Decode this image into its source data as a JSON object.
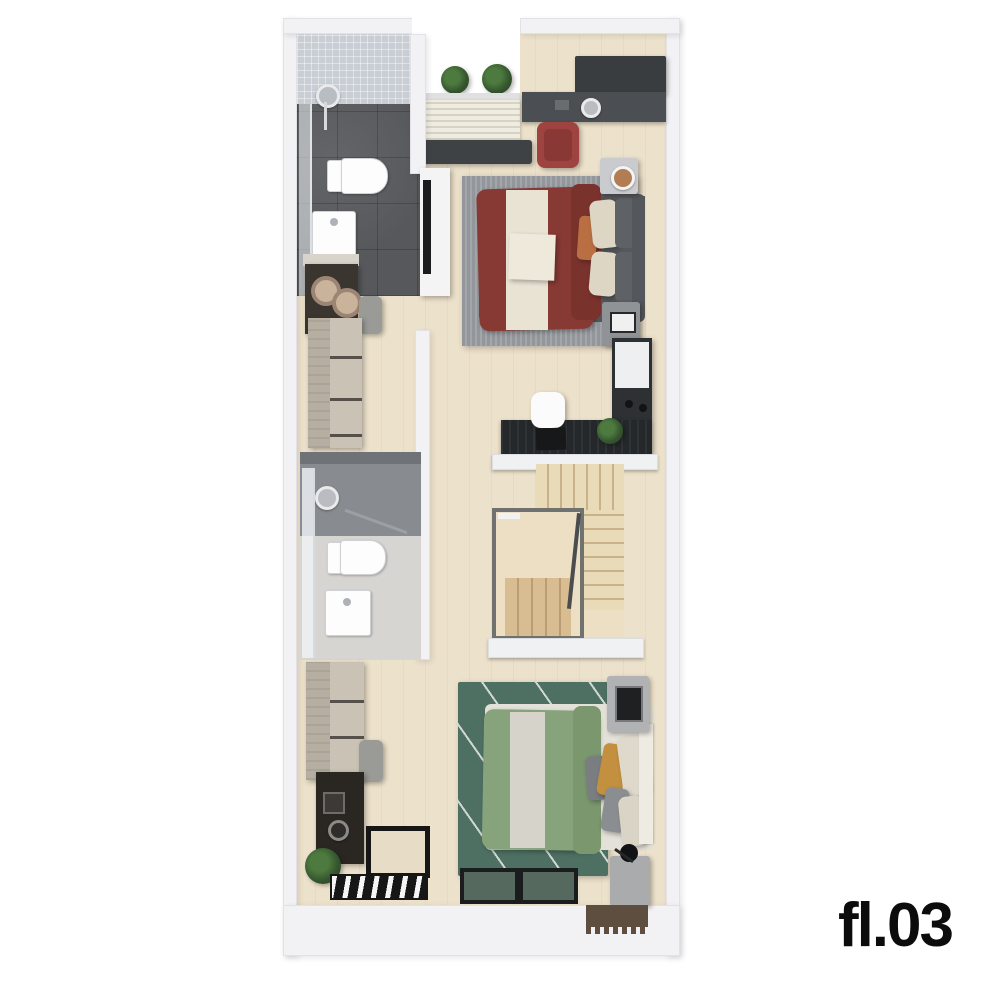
{
  "floor_label": "fl.03",
  "plan_type": "3d-floorplan-top-view",
  "visible_items": [
    "bathroom-1 shower toilet sink (dark tile)",
    "balcony planters",
    "window blinds",
    "air-conditioner",
    "bedroom-1 red bed, gray rug, desk, red chair, tv-console, nightstands with lamp",
    "walk-in closet dressers, double-basin vanity, bench",
    "study desk with white chair, laptop, plant, wardrobe",
    "u-shaped staircase with stairwell void",
    "bathroom-2 shower toilet sink (light tile)",
    "coffee counter, plant, floor grate",
    "bedroom-2 green bed, green rug, yellow pillow, nightstands, windows, doormat"
  ],
  "colors": {
    "wall": "#f2f2f4",
    "wallEdge": "#e2e2e6",
    "floorWood": "#ece1cb",
    "bath1Wall": "#c9ced5",
    "bath1Floor": "#56585b",
    "bath2Top": "#6f7276",
    "bath2Shower": "#888b8f",
    "bath2Floor": "#d7d5d2",
    "glass": "#eef1f4",
    "rugGray": "#93969a",
    "rugGrayStripe": "#a3a6aa",
    "bedFrame1": "#55585c",
    "bedRed": "#873a34",
    "bedRedFold": "#7a322d",
    "cream": "#e9e3d4",
    "pillowBeige": "#ddd6c4",
    "pillowOrange": "#b96f41",
    "pillowGrayDark": "#5e6165",
    "headboard1": "#54575b",
    "deskTop": "#4b4e52",
    "shelfDark": "#3a3d40",
    "chairRed": "#9f4340",
    "chairRedSeat": "#8a3835",
    "consoleWhite": "#f4f4f5",
    "tvBlack": "#1b1c1e",
    "woodDresser": "#b5aea1",
    "woodDrawer": "#c9c2b5",
    "drawerGap": "#55504a",
    "vanityDark": "#3b352f",
    "basinRim": "#9c8574",
    "basinFill": "#c9b39b",
    "benchGray": "#9a9b97",
    "wardrobeDark": "#2e3134",
    "cabinetWhite": "#edeff0",
    "deskBlack": "#25282b",
    "chairWhite": "#fbfbfc",
    "laptopBlack": "#17181a",
    "ledge": "#f0f1f3",
    "stairLight": "#e9dab8",
    "stairLine": "#c9b18a",
    "stairDark": "#d8bd93",
    "stairDarkLine": "#bb9d71",
    "stairFrame": "#70726f",
    "stairWell": "#ecdfc4",
    "railing": "#4a4c4e",
    "rugGreen": "#4e7063",
    "rugGreenStripe": "#cfd8d2",
    "bedFrame2": "#e3e1d8",
    "bedGreen": "#87a37b",
    "bedGreenFold": "#7a976d",
    "runner2": "#d6d3ca",
    "pillowYellow": "#c3903f",
    "pillowGrayMid": "#7b7e81",
    "pillowCream": "#ded9cb",
    "headboard2": "#edebe2",
    "concrete": "#b0b2b4",
    "concreteDark": "#a9abad",
    "deviceBlack": "#1f2022",
    "counterDark": "#2a2723",
    "applianceDark": "#3b3a36",
    "plantGreen": "#35552f",
    "plantDark": "#22401d",
    "grateBlack": "#161616",
    "grateWhite": "#f5f5f5",
    "windowFrame": "#1b1c1e",
    "windowFill": "#56695f",
    "doormat": "#5e4e3f",
    "acDark": "#3f4245",
    "blindCream": "#efece2",
    "blindLine": "#d8d2c2",
    "sillGray": "#e0e0e3",
    "porcelain": "#fdfdfd",
    "labelBlack": "#0c0c0c"
  }
}
